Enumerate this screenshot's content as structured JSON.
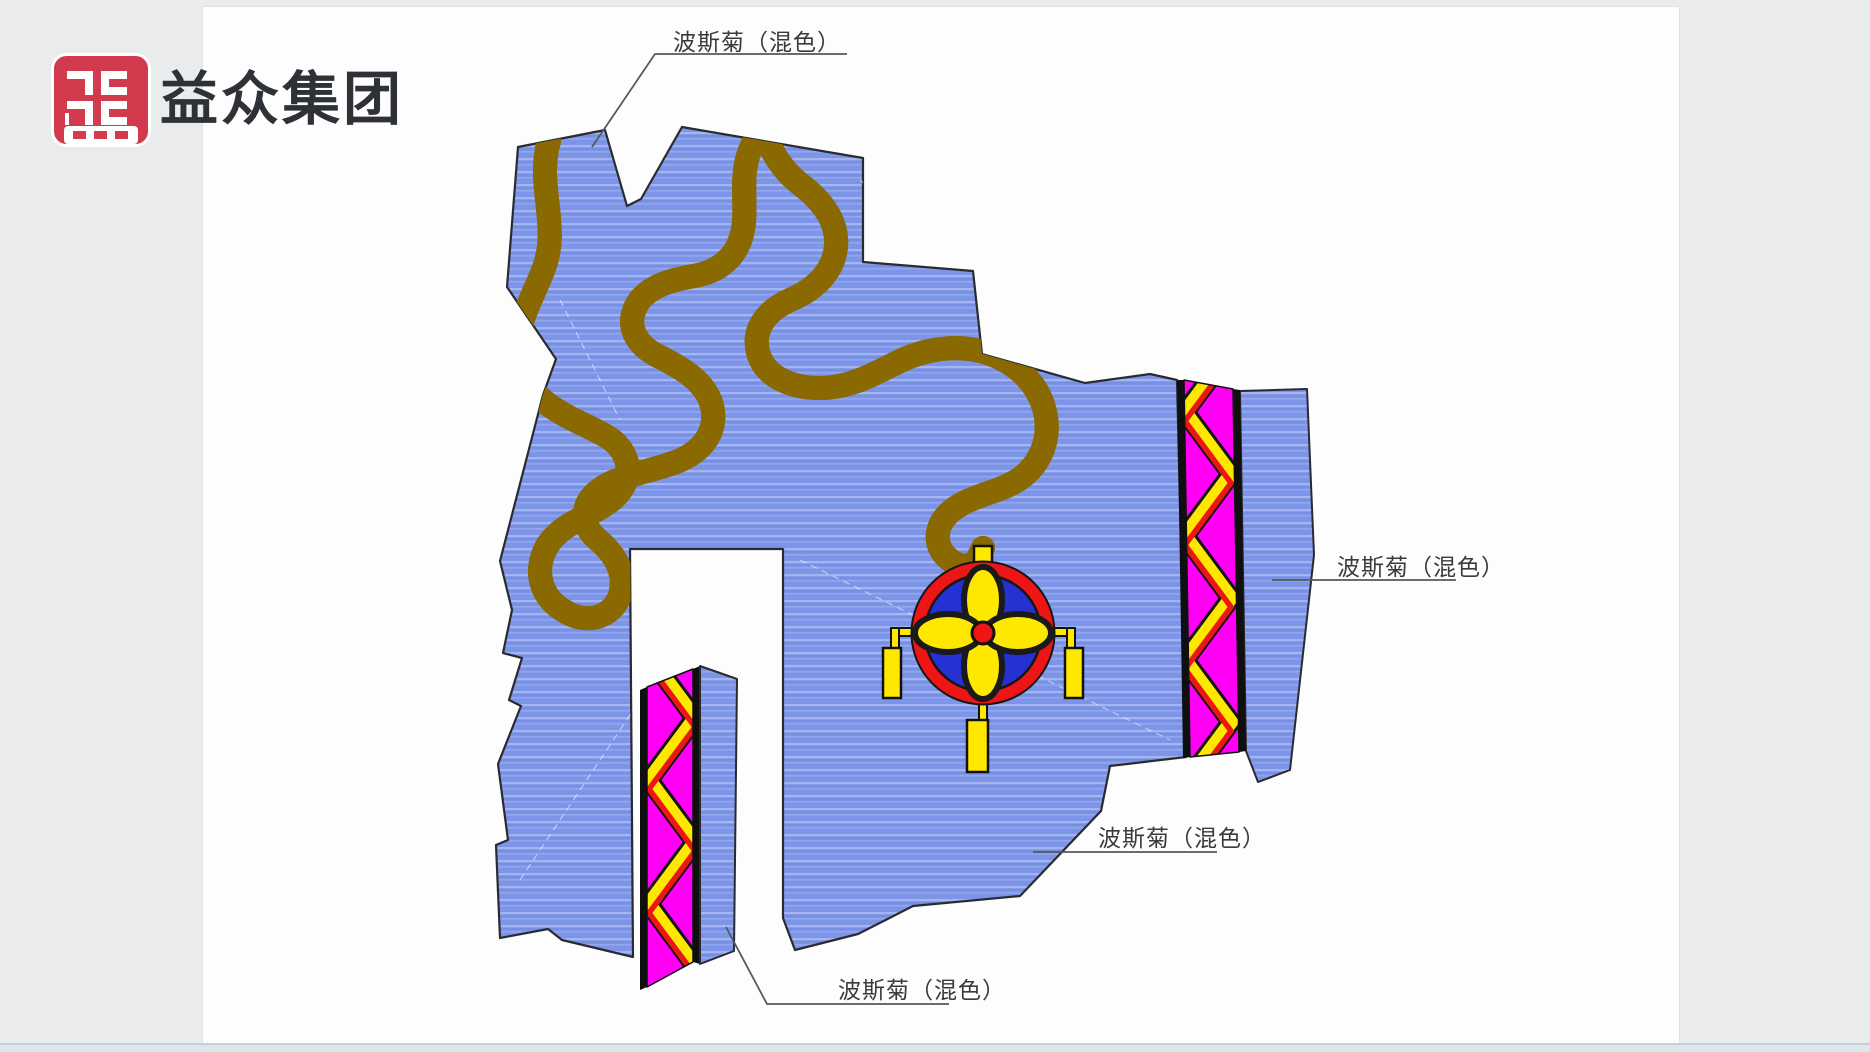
{
  "logo": {
    "text": "益众集团"
  },
  "labels": [
    {
      "position": "top",
      "text": "波斯菊（混色）"
    },
    {
      "position": "right",
      "text": "波斯菊（混色）"
    },
    {
      "position": "middle",
      "text": "波斯菊（混色）"
    },
    {
      "position": "bottom",
      "text": "波斯菊（混色）"
    }
  ],
  "colors": {
    "bg": "#e9ebed",
    "paper": "#fdfdfe",
    "footer": "#dde6ea",
    "footer-line": "#c5d1d6",
    "ink": "#2e3237",
    "label": "#3b3b3b",
    "logo-red": "#d23a4e",
    "field": "#7d95e8",
    "outline": "#2a2a30",
    "magenta": "#ff00f5",
    "yellow": "#ffe800",
    "red": "#ed1515",
    "path-edge": "#8a6a00",
    "ring-blue": "#2531d0",
    "leader": "#55585c"
  }
}
